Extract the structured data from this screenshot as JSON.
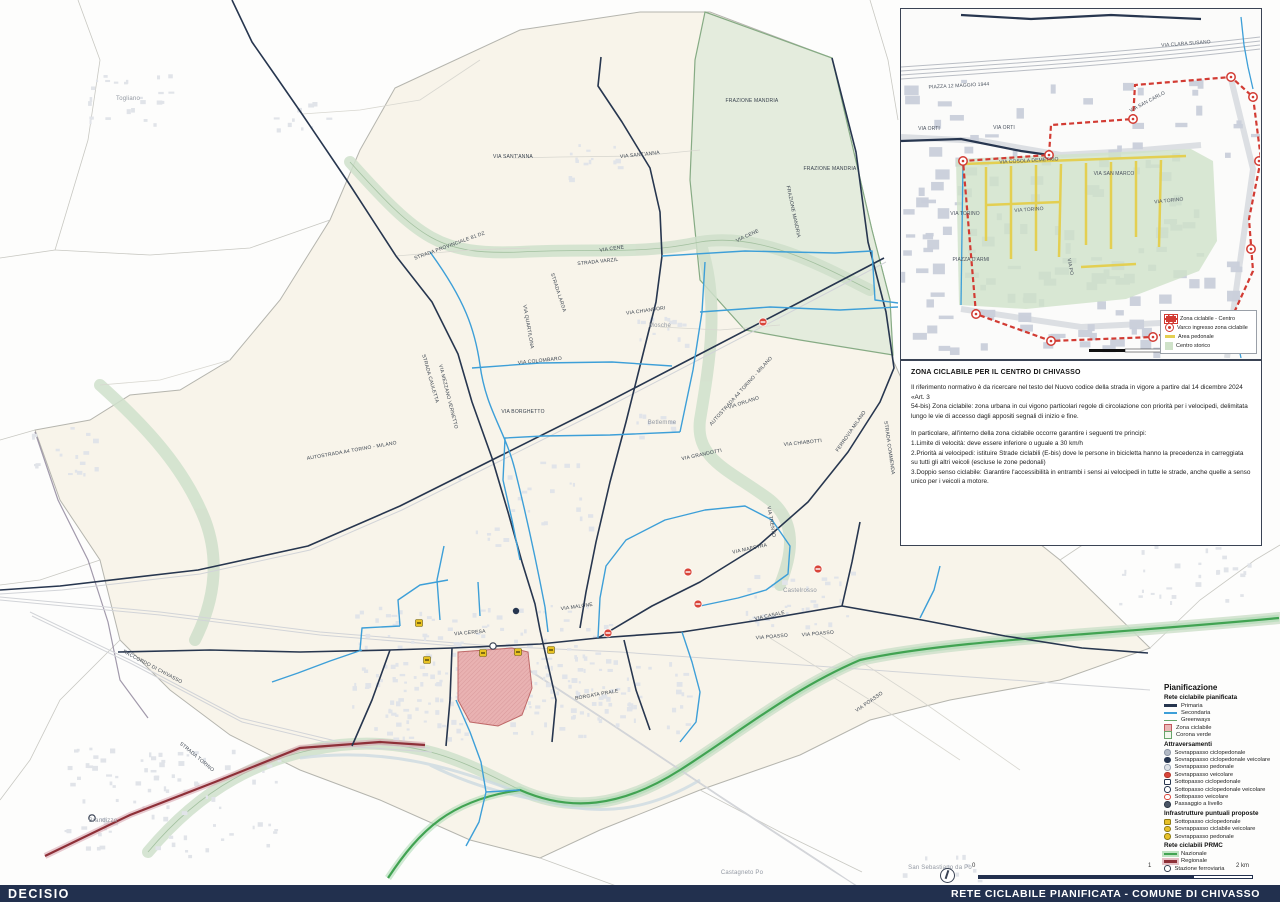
{
  "footer": {
    "brand": "DECISIO",
    "title": "RETE CICLABILE PIANIFICATA - COMUNE DI CHIVASSO"
  },
  "info": {
    "title": "ZONA CICLABILE PER IL CENTRO DI CHIVASSO",
    "paragraphs": [
      "Il riferimento normativo è da ricercare nel testo del Nuovo codice della strada in vigore a partire dal 14 dicembre 2024",
      "«Art. 3",
      "54-bis) Zona ciclabile: zona urbana in cui vigono particolari regole di circolazione con priorità per i velocipedi, delimitata lungo le vie di accesso dagli appositi segnali di inizio e fine.",
      "",
      "In particolare, all'interno della zona ciclabile occorre  garantire i seguenti tre principi:",
      "1.Limite di velocità: deve essere inferiore o uguale a 30 km/h",
      "2.Priorità ai velocipedi: istituire Strade ciclabili  (E-bis) dove le persone in bicicletta hanno la precedenza in carreggiata su tutti gli altri veicoli (escluse le zone pedonali)",
      "3.Doppio senso ciclabile: Garantire l'accessibilità in entrambi i sensi ai velocipedi in tutte le strade, anche quelle a senso unico per i veicoli a motore."
    ]
  },
  "legend": {
    "title": "Pianificazione",
    "sections": [
      {
        "title": "Rete ciclabile pianificata",
        "items": [
          {
            "label": "Primaria",
            "swatch": {
              "type": "line",
              "color": "#27364f",
              "weight": 3
            }
          },
          {
            "label": "Secondaria",
            "swatch": {
              "type": "line",
              "color": "#3d9fd8",
              "weight": 2
            }
          },
          {
            "label": "Greenways",
            "swatch": {
              "type": "line",
              "color": "#69a56b",
              "weight": 1.5
            }
          },
          {
            "label": "Zona ciclabile",
            "swatch": {
              "type": "area",
              "fill": "#eab7b7",
              "border": "#c2585e"
            }
          },
          {
            "label": "Corona verde",
            "swatch": {
              "type": "area",
              "fill": "#f3f6ee",
              "border": "#69a56b"
            }
          }
        ]
      },
      {
        "title": "Attraversamenti",
        "items": [
          {
            "label": "Sovrappasso ciclopedonale",
            "swatch": {
              "type": "dot",
              "fill": "#b3bac5",
              "border": "#8d96a5",
              "shape": "round"
            }
          },
          {
            "label": "Sovrappasso ciclopedonale veicolare",
            "swatch": {
              "type": "dot",
              "fill": "#27364f",
              "border": "#27364f",
              "shape": "round"
            }
          },
          {
            "label": "Sovrappasso pedonale",
            "swatch": {
              "type": "dot",
              "fill": "#dfe3e8",
              "border": "#9aa2b0",
              "shape": "round"
            }
          },
          {
            "label": "Sovrappasso veicolare",
            "swatch": {
              "type": "dot",
              "fill": "#d9453a",
              "border": "#b43328",
              "shape": "round"
            }
          },
          {
            "label": "Sottopasso ciclopedonale",
            "swatch": {
              "type": "dot",
              "fill": "#ffffff",
              "border": "#27364f",
              "shape": "square"
            }
          },
          {
            "label": "Sottopasso ciclopedonale veicolare",
            "swatch": {
              "type": "dot",
              "fill": "#ffffff",
              "border": "#27364f",
              "shape": "round"
            }
          },
          {
            "label": "Sottopasso veicolare",
            "swatch": {
              "type": "dot",
              "fill": "#ffffff",
              "border": "#d9453a",
              "shape": "round"
            }
          },
          {
            "label": "Passaggio a livello",
            "swatch": {
              "type": "dot",
              "fill": "#4a5565",
              "border": "#2e3947",
              "shape": "round"
            }
          }
        ]
      },
      {
        "title": "Infrastrutture puntuali proposte",
        "items": [
          {
            "label": "Sottopasso ciclopedonale",
            "swatch": {
              "type": "dot",
              "fill": "#e8c129",
              "border": "#8d7a14",
              "shape": "square"
            }
          },
          {
            "label": "Sovrappasso ciclabile veicolare",
            "swatch": {
              "type": "dot",
              "fill": "#e8c129",
              "border": "#8d7a14",
              "shape": "round"
            }
          },
          {
            "label": "Sovrappasso pedonale",
            "swatch": {
              "type": "dot",
              "fill": "#e8c129",
              "border": "#8d7a14",
              "shape": "round"
            }
          }
        ]
      },
      {
        "title": "Rete ciclabili PRMC",
        "items": [
          {
            "label": "Nazionale",
            "swatch": {
              "type": "line",
              "color": "#41a352",
              "weight": 2.5,
              "glow": "#bfe3c2"
            }
          },
          {
            "label": "Regionale",
            "swatch": {
              "type": "line",
              "color": "#8e3038",
              "weight": 2.5,
              "glow": "#e5c0c6"
            }
          },
          {
            "label": "Stazione ferroviaria",
            "swatch": {
              "type": "dot",
              "fill": "#ffffff",
              "border": "#3a4354",
              "shape": "ring"
            }
          }
        ]
      }
    ]
  },
  "inset": {
    "legend_items": [
      {
        "label": "Zona ciclabile - Centro",
        "swatch": "red-dashed-area"
      },
      {
        "label": "Varco ingresso zona ciclabile",
        "swatch": "red-gate"
      },
      {
        "label": "Area pedonale",
        "swatch": "yellow-line"
      },
      {
        "label": "Centro storico",
        "swatch": "green-area"
      }
    ],
    "labels": [
      {
        "t": "VIA CLARA SUSANO",
        "x": 285,
        "y": 36,
        "r": -4
      },
      {
        "t": "PIAZZA 12 MAGGIO 1944",
        "x": 58,
        "y": 78,
        "r": -3
      },
      {
        "t": "VIA ORTI",
        "x": 28,
        "y": 121,
        "r": 0
      },
      {
        "t": "VIA ORTI",
        "x": 103,
        "y": 120,
        "r": 0
      },
      {
        "t": "VIA COSOLA DEMETRIO",
        "x": 128,
        "y": 153,
        "r": -3
      },
      {
        "t": "VIA SAN CARLO",
        "x": 247,
        "y": 94,
        "r": -28
      },
      {
        "t": "VIA SAN MARCO",
        "x": 213,
        "y": 166,
        "r": 0
      },
      {
        "t": "VIA TORINO",
        "x": 64,
        "y": 206,
        "r": 0
      },
      {
        "t": "VIA TORINO",
        "x": 128,
        "y": 202,
        "r": -4
      },
      {
        "t": "VIA TORINO",
        "x": 268,
        "y": 193,
        "r": -6
      },
      {
        "t": "PIAZZA D'ARMI",
        "x": 70,
        "y": 252,
        "r": 0
      },
      {
        "t": "VIA PO",
        "x": 168,
        "y": 258,
        "r": 80
      }
    ]
  },
  "scalebar": {
    "labels": {
      "start": "0",
      "middle": "1",
      "end": "2 km"
    }
  },
  "map": {
    "street_labels": [
      {
        "t": "VIA SANT'ANNA",
        "x": 513,
        "y": 158,
        "r": 0
      },
      {
        "t": "VIA SANT'ANNA",
        "x": 640,
        "y": 156,
        "r": -6
      },
      {
        "t": "FRAZIONE MANDRIA",
        "x": 752,
        "y": 102,
        "r": 0
      },
      {
        "t": "FRAZIONE MANDRIA",
        "x": 830,
        "y": 170,
        "r": 0
      },
      {
        "t": "FRAZIONE MANDRIA",
        "x": 792,
        "y": 212,
        "r": 78
      },
      {
        "t": "STRADA PROVINCIALE 81 DZ",
        "x": 450,
        "y": 247,
        "r": -20
      },
      {
        "t": "VIA CENE",
        "x": 612,
        "y": 250,
        "r": -8
      },
      {
        "t": "VIA CENE",
        "x": 748,
        "y": 237,
        "r": -25
      },
      {
        "t": "STRADA VARZIL",
        "x": 598,
        "y": 263,
        "r": -6
      },
      {
        "t": "VIA CHIANDORI",
        "x": 646,
        "y": 312,
        "r": -8
      },
      {
        "t": "STRADA LARGA",
        "x": 557,
        "y": 293,
        "r": 72
      },
      {
        "t": "VIA QUARTILONA",
        "x": 527,
        "y": 327,
        "r": 80
      },
      {
        "t": "VIA COLOMBARO",
        "x": 540,
        "y": 362,
        "r": -6
      },
      {
        "t": "VIA BORGHETTO",
        "x": 523,
        "y": 413,
        "r": 0
      },
      {
        "t": "STRADA CAULETTA",
        "x": 429,
        "y": 379,
        "r": 74
      },
      {
        "t": "VIA MEZZANO VERNETTO",
        "x": 447,
        "y": 397,
        "r": 76
      },
      {
        "t": "VIA ORLANO",
        "x": 744,
        "y": 404,
        "r": -18
      },
      {
        "t": "VIA CHIABOTTI",
        "x": 803,
        "y": 444,
        "r": -6
      },
      {
        "t": "VIA GRANDOTTI",
        "x": 702,
        "y": 456,
        "r": -12
      },
      {
        "t": "AUTOSTRADA A4 TORINO - MILANO",
        "x": 352,
        "y": 452,
        "r": -10
      },
      {
        "t": "AUTOSTRADA A4 TORINO - MILANO",
        "x": 742,
        "y": 392,
        "r": -48
      },
      {
        "t": "FERROVIA MILANO",
        "x": 852,
        "y": 432,
        "r": -55
      },
      {
        "t": "STRADA COMMENDA",
        "x": 888,
        "y": 448,
        "r": 82
      },
      {
        "t": "VIA MAESTRA",
        "x": 750,
        "y": 550,
        "r": -12
      },
      {
        "t": "VIA TRENTO",
        "x": 770,
        "y": 522,
        "r": 80
      },
      {
        "t": "VIA MALONE",
        "x": 577,
        "y": 608,
        "r": -8
      },
      {
        "t": "VIA CERESA",
        "x": 470,
        "y": 634,
        "r": -5
      },
      {
        "t": "VIA CASALE",
        "x": 770,
        "y": 617,
        "r": -12
      },
      {
        "t": "VIA POASSO",
        "x": 772,
        "y": 638,
        "r": -5
      },
      {
        "t": "VIA POASSO",
        "x": 818,
        "y": 635,
        "r": -5
      },
      {
        "t": "VIA POASSO",
        "x": 870,
        "y": 703,
        "r": -35
      },
      {
        "t": "BORGATA PRALE",
        "x": 597,
        "y": 696,
        "r": -10
      },
      {
        "t": "STRADA TORINO",
        "x": 196,
        "y": 758,
        "r": 40
      },
      {
        "t": "RACCORDO DI CHIVASSO",
        "x": 152,
        "y": 668,
        "r": 28
      }
    ],
    "towns": [
      {
        "t": "Togliano",
        "x": 128,
        "y": 100
      },
      {
        "t": "Mosche",
        "x": 660,
        "y": 327
      },
      {
        "t": "Betlemme",
        "x": 662,
        "y": 424
      },
      {
        "t": "Castelrosso",
        "x": 800,
        "y": 592
      },
      {
        "t": "Brandizzo",
        "x": 103,
        "y": 822
      },
      {
        "t": "Castagneto Po",
        "x": 742,
        "y": 874
      },
      {
        "t": "San Sebastiano da Po",
        "x": 940,
        "y": 869
      }
    ],
    "markers": {
      "red_circles": [
        [
          763,
          322
        ],
        [
          818,
          569
        ],
        [
          698,
          604
        ],
        [
          608,
          633
        ],
        [
          688,
          572
        ]
      ],
      "yellow_squares": [
        [
          419,
          623
        ],
        [
          427,
          660
        ],
        [
          483,
          653
        ],
        [
          518,
          652
        ],
        [
          551,
          650
        ]
      ],
      "navy_dots": [
        [
          516,
          611
        ]
      ],
      "stations": [
        [
          493,
          646
        ],
        [
          92,
          818
        ]
      ]
    }
  },
  "colors": {
    "footer_navy": "#22304e",
    "primary_line": "#27364f",
    "secondary_line": "#3d9fd8",
    "greenway": "#69a56b",
    "nazionale": "#41a352",
    "regionale": "#8e3038",
    "zona_ciclabile": "#e8b0b0",
    "marker_red": "#d9453a",
    "marker_yellow": "#e8c222",
    "centro_storico": "#cfe2c9",
    "area_pedonale": "#e3cf52",
    "zona_centro_red": "#d23b33"
  }
}
